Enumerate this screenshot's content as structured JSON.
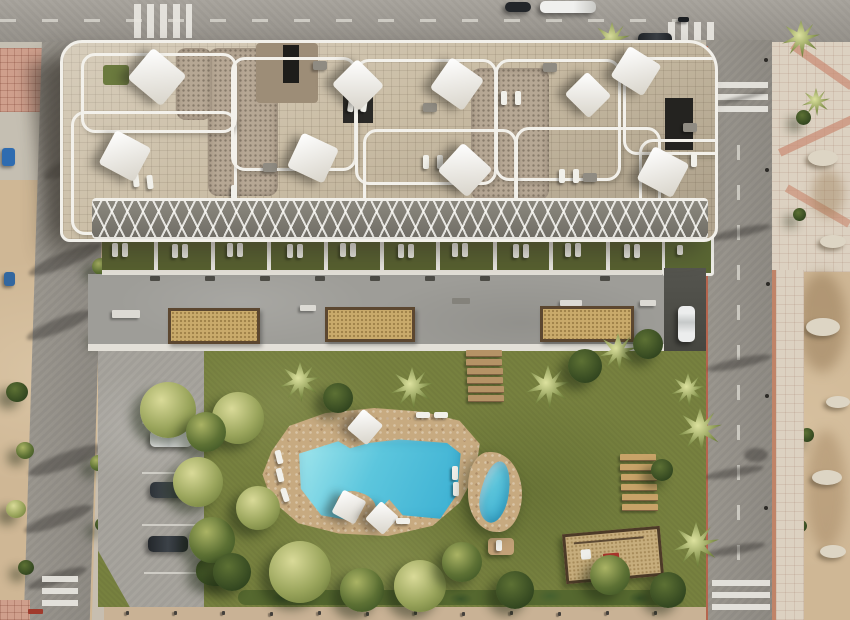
{
  "scene": {
    "title": "Aerial render of a residential apartment block with rooftop terraces, communal garden and free-form pool",
    "environment": "New-build complex bounded by an asphalt road on top, tree-lined street on the left, palm-lined avenue on the right and sandy undeveloped plots"
  },
  "palette": {
    "sand": "#cfb795",
    "asphalt": "#9b978f",
    "sidewalk_tile": "#dcd1c1",
    "pink_tile": "#cf9f8c",
    "roof_paving": "#cabda5",
    "roof_gravel": "#b6a794",
    "parapet_white": "#f2f0ea",
    "terrace_lawn": "#57602f",
    "plaza_concrete": "#9e9d98",
    "planter_sand": "#c9aa6b",
    "garden_lawn": "#77813f",
    "pool_deck": "#c7aa80",
    "pool_water_light": "#a8e9ee",
    "pool_water_deep": "#39aed2",
    "tree_green": "#5d7134",
    "red_accent": "#b5654e"
  },
  "counts": {
    "shade_sails": 9,
    "rooftop_loungers": 12,
    "ground_floor_terraces": 10,
    "planter_boxes": 3,
    "wooden_steps": 6,
    "wooden_lounger_row": 6,
    "street_crosswalks": 5,
    "vehicles_visible": 7,
    "pools": 2,
    "street_lamps": 5
  },
  "labels": {
    "main_pool": "free-form turquoise pool with sun deck",
    "small_pool": "kidney-shaped splash pool",
    "playground": "sand playground with play equipment",
    "parking": "residents parking strip with three parked cars",
    "driveway": "side driveway with white car"
  }
}
